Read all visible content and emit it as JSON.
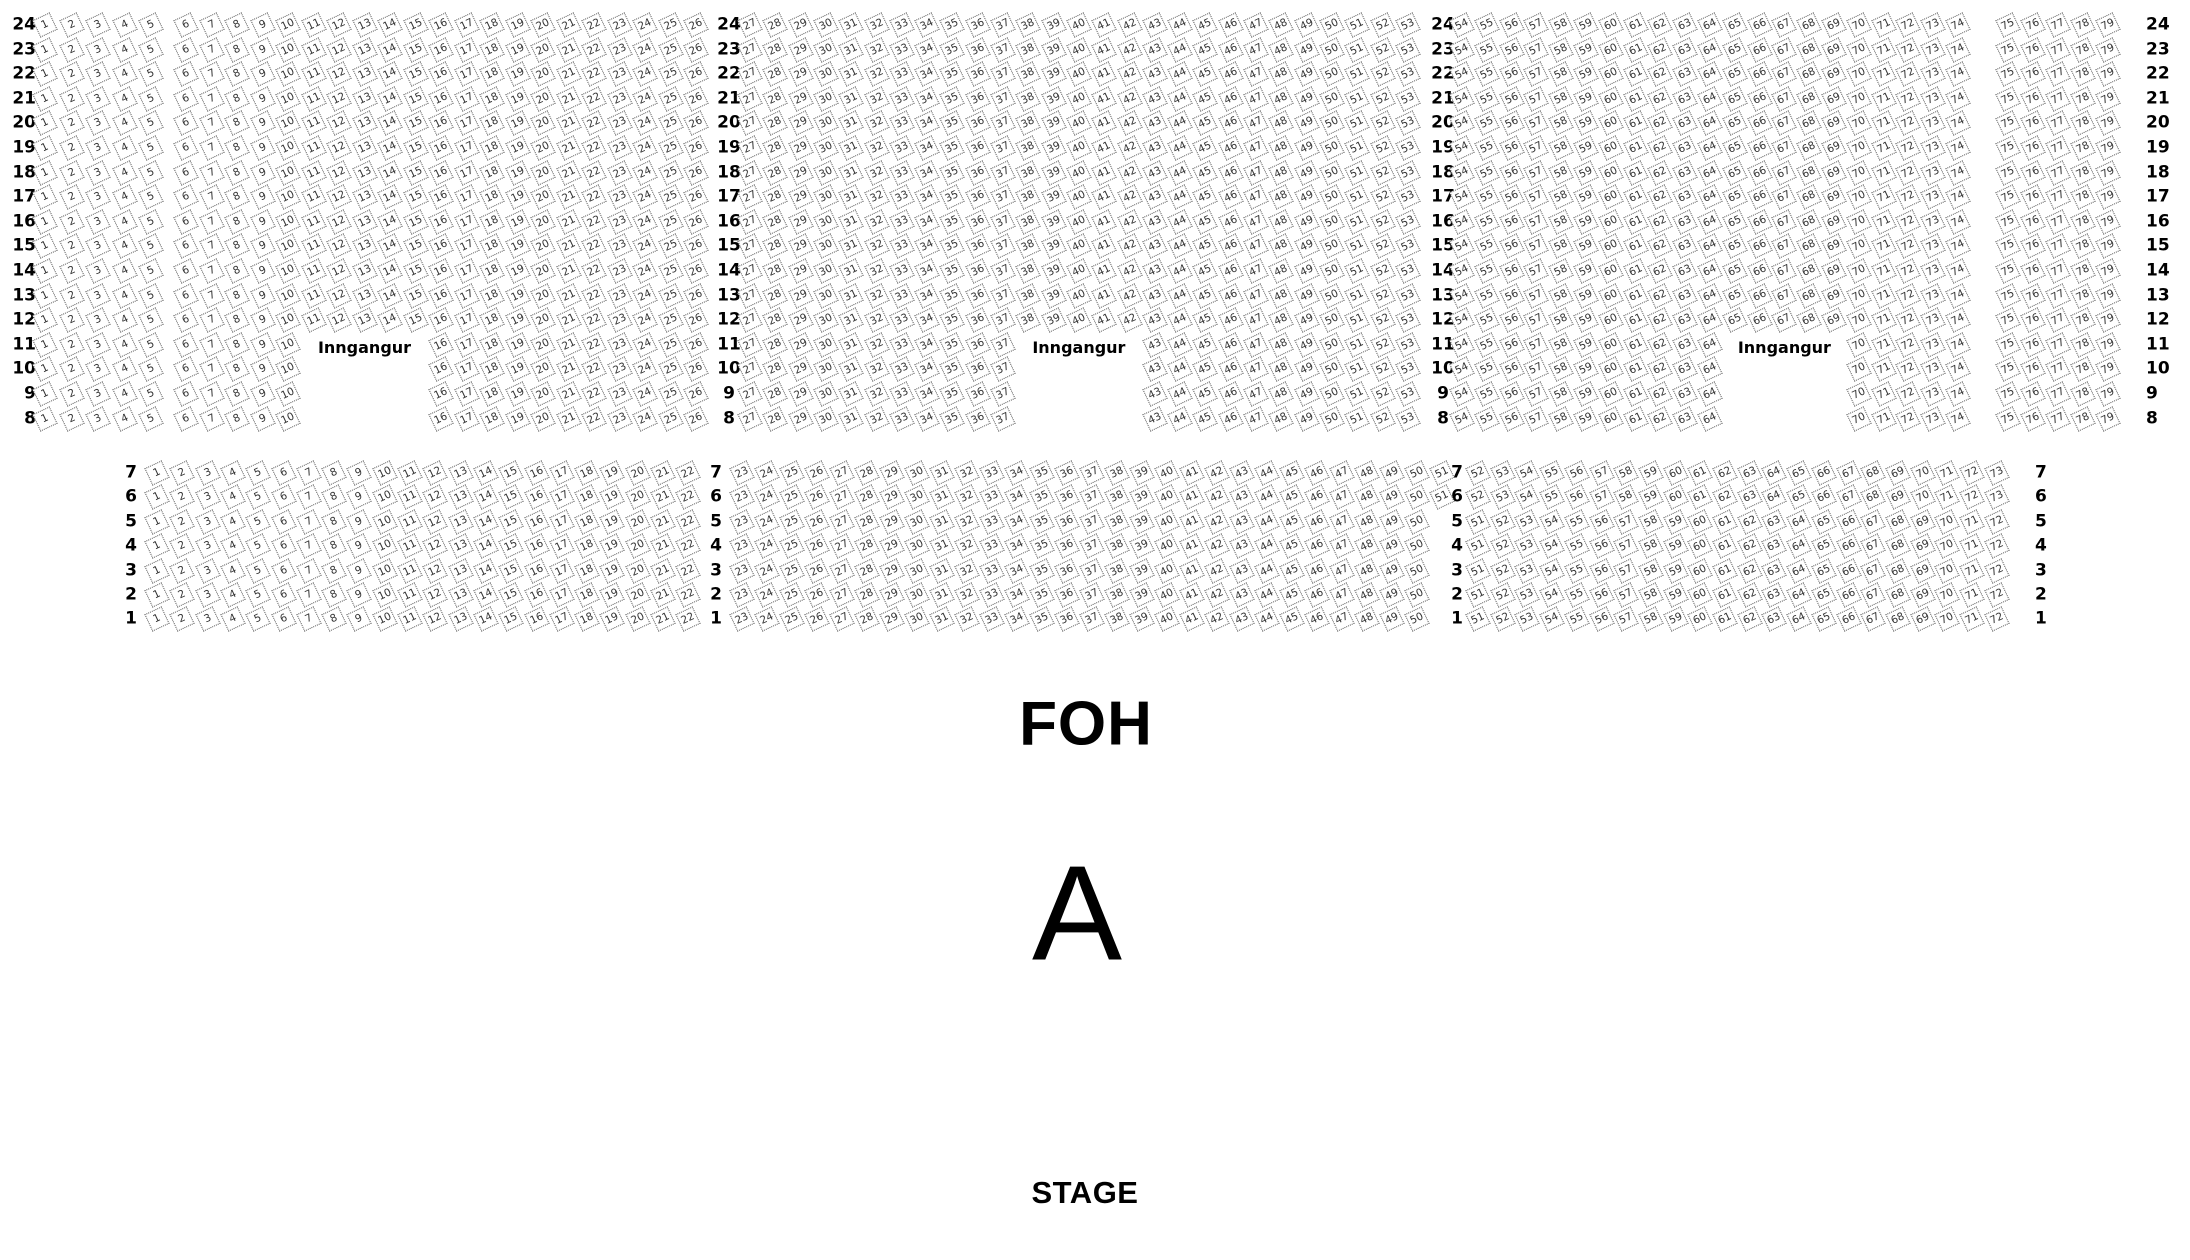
{
  "labels": {
    "foh": "FOH",
    "section_letter": "A",
    "stage": "STAGE",
    "entrance": "Inngangur"
  },
  "colors": {
    "seat_border": "#555555",
    "seat_text": "#333333",
    "label_text": "#000000"
  },
  "rear_section": {
    "rows": [
      24,
      23,
      22,
      21,
      20,
      19,
      18,
      17,
      16,
      15,
      14,
      13,
      12,
      11,
      10,
      9,
      8
    ],
    "gap_rows": [
      11,
      10,
      9,
      8
    ],
    "blocks": [
      {
        "id": "a",
        "first": 1,
        "last": 5
      },
      {
        "id": "b",
        "first": 6,
        "last": 26,
        "gap_first": 11,
        "gap_last": 15,
        "gap_rows": [
          11,
          10,
          9,
          8
        ],
        "entrance_row": 11
      },
      {
        "id": "c",
        "first": 27,
        "last": 53,
        "gap_first": 38,
        "gap_last": 42,
        "gap_rows": [
          11,
          10,
          9,
          8
        ],
        "entrance_row": 11
      },
      {
        "id": "d",
        "first": 54,
        "last": 74,
        "gap_first": 65,
        "gap_last": 69,
        "gap_rows": [
          11,
          10,
          9,
          8
        ],
        "entrance_row": 11
      },
      {
        "id": "e",
        "first": 75,
        "last": 79
      }
    ]
  },
  "front_section": {
    "rows": [
      7,
      6,
      5,
      4,
      3,
      2,
      1
    ],
    "blocks": [
      {
        "id": "f1",
        "first": 1,
        "last": 22
      },
      {
        "id": "f2",
        "first": 23,
        "last": 51,
        "row_overrides": {
          "5": [
            23,
            50
          ],
          "4": [
            23,
            50
          ],
          "3": [
            23,
            50
          ],
          "2": [
            23,
            50
          ],
          "1": [
            23,
            50
          ]
        }
      },
      {
        "id": "f3",
        "first": 52,
        "last": 73,
        "row_overrides": {
          "5": [
            51,
            72
          ],
          "4": [
            51,
            72
          ],
          "3": [
            51,
            72
          ],
          "2": [
            51,
            72
          ],
          "1": [
            51,
            72
          ]
        }
      }
    ]
  }
}
